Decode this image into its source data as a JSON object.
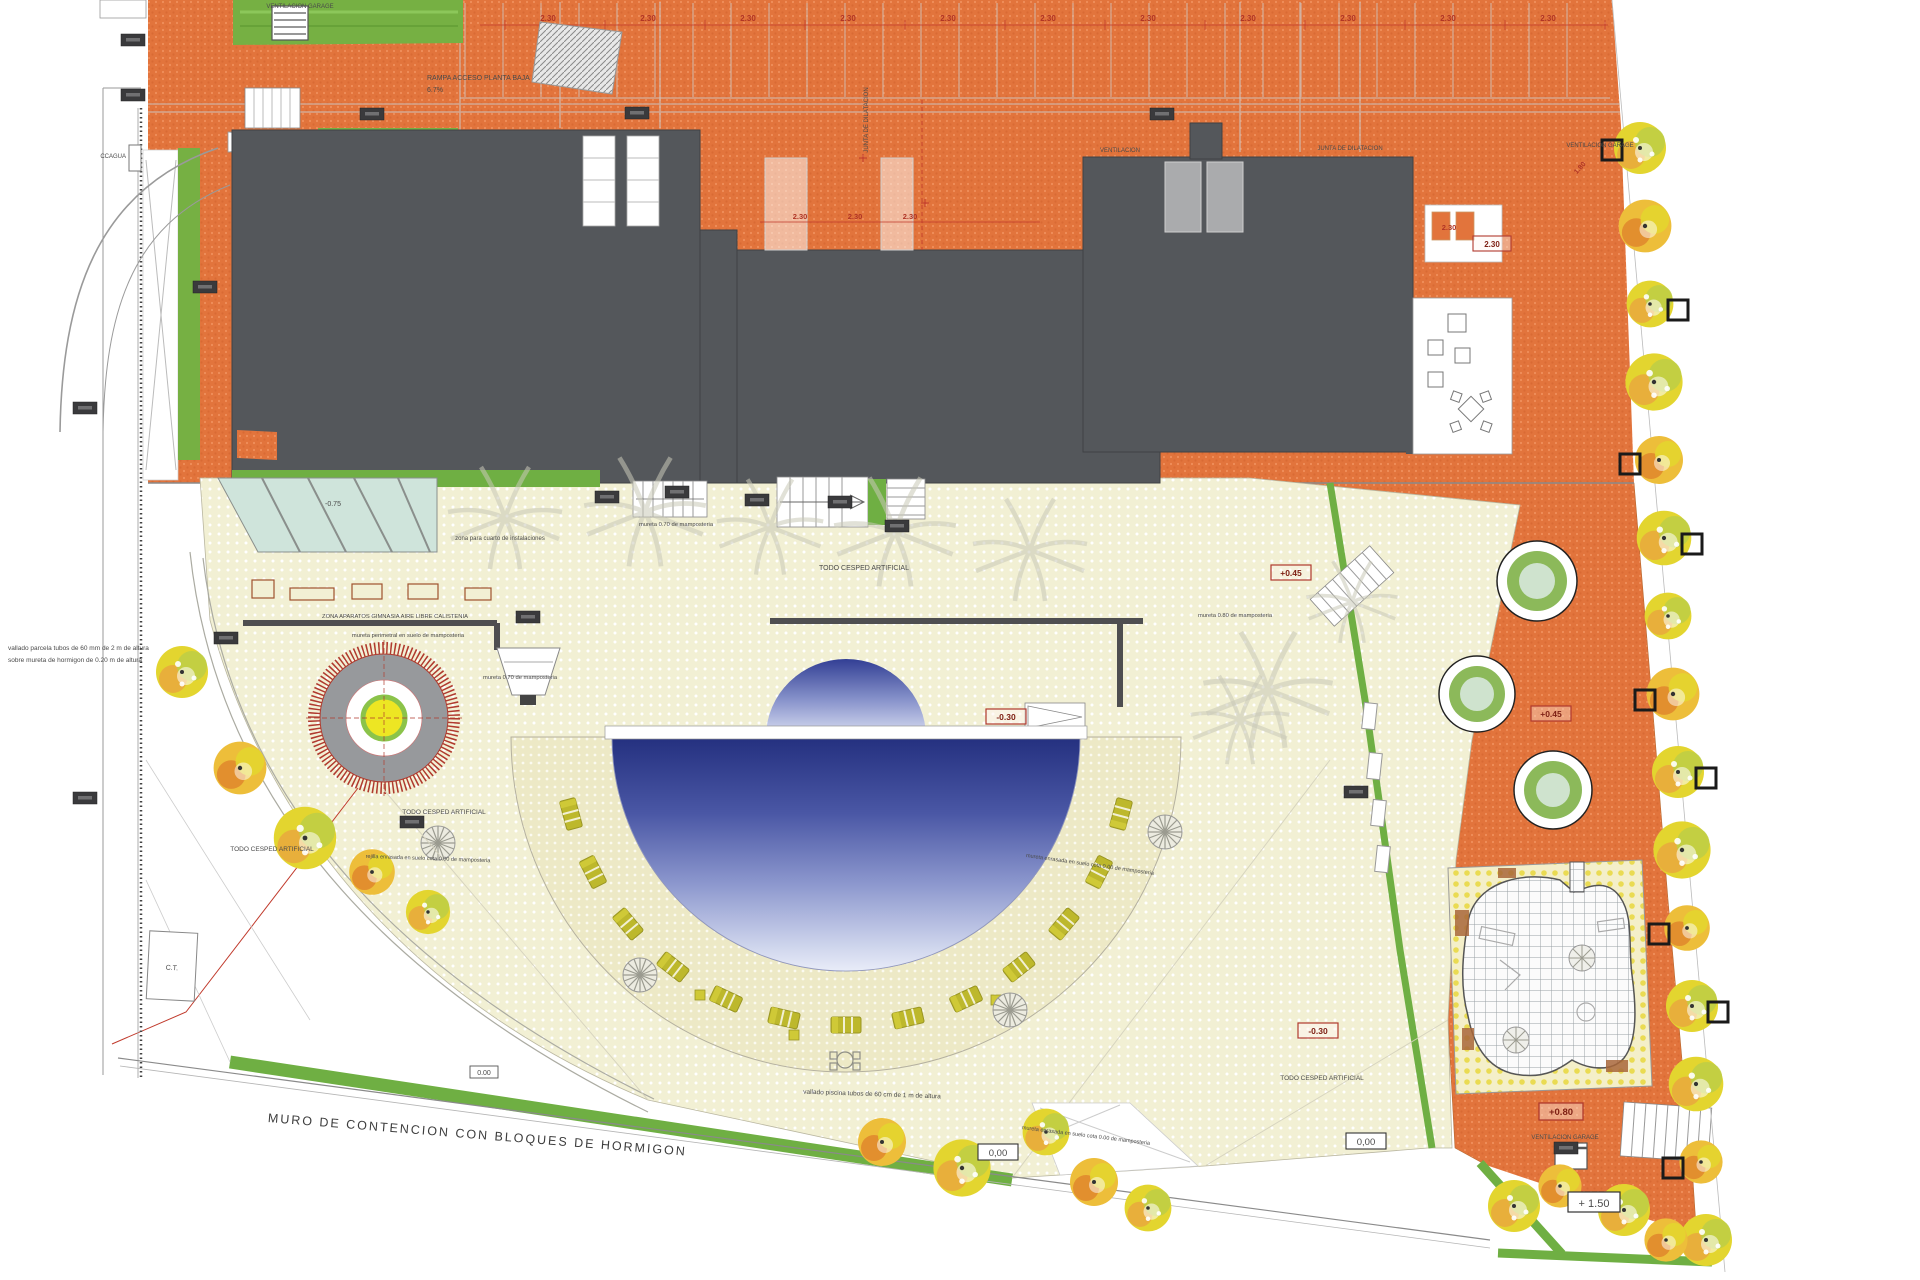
{
  "plan": {
    "annotations": {
      "ventilacion_garage": "VENTILACION GARAGE",
      "rampa": "RAMPA ACCESO PLANTA BAJA",
      "rampa_slope": "6.7%",
      "slope10": "10%",
      "junta": "JUNTA DE DILATACION",
      "ventilacion": "VENTILACION",
      "ccagua": "CCAGUA",
      "zona_inst": "zona para cuarto de instalaciones",
      "zona_gym": "ZONA APARATOS GIMNASIA AIRE LIBRE CALISTENIA",
      "mureta_perimetral": "mureta perimetral en suelo de mamposteria",
      "mureta070": "mureta 0.70 de mamposteria",
      "mureta080": "mureta 0.80 de mamposteria",
      "cesped": "TODO CESPED ARTIFICIAL",
      "vallado1": "vallado parcela tubos de 60 mm de 2 m de altura",
      "vallado2": "sobre mureta de hormigon de 0.20 m de altura",
      "vallado_piscina": "vallado piscina tubos de 60 cm de 1 m de altura",
      "rejilla": "rejilla enrasada en suelo cota 0.00 de mamposteria",
      "mureta_enrasada": "mureta enrasada en suelo cota 0.00 de mamposteria",
      "muro": "MURO DE CONTENCION  CON BLOQUES DE HORMIGON",
      "ct": "C.T."
    },
    "levels": {
      "m075": "-0.75",
      "m030": "-0.30",
      "p045": "+0.45",
      "p080": "+0.80",
      "p150": "+ 1.50",
      "cero": "0,00",
      "cero2": "0.00"
    },
    "dimensions": {
      "bay": "2.30",
      "pit": "1.80"
    },
    "colors": {
      "deck_orange": "#E2743C",
      "roof_gray": "#54575B",
      "lawn_cream": "#F2F0D4",
      "hedge_green": "#6FAF43",
      "pool_dark": "#24307F",
      "pool_light": "#EDF0FA",
      "tree_yellow": "#E3D52F",
      "accent_red": "#B03A2E"
    }
  }
}
